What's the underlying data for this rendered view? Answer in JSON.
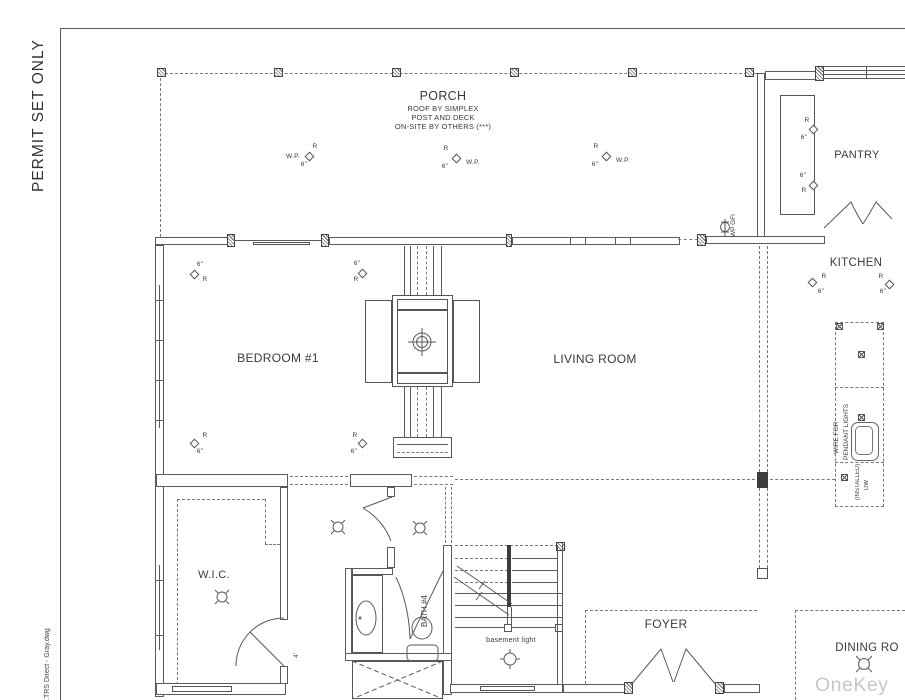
{
  "sheet": {
    "permit_stamp": "PERMIT SET ONLY",
    "file_name": ".TRS Direct - Gray.dwg",
    "watermark": "OneKey MLS"
  },
  "rooms": {
    "porch": {
      "label": "PORCH",
      "notes": [
        "ROOF BY SIMPLEX",
        "POST AND DECK",
        "ON-SITE BY OTHERS (***)"
      ]
    },
    "pantry": {
      "label": "PANTRY"
    },
    "kitchen": {
      "label": "KITCHEN"
    },
    "bedroom1": {
      "label": "BEDROOM #1"
    },
    "living_room": {
      "label": "LIVING ROOM"
    },
    "wic": {
      "label": "W.I.C."
    },
    "bath4": {
      "label": "BATH #4"
    },
    "foyer": {
      "label": "FOYER"
    },
    "dining_room": {
      "label": "DINING RO"
    }
  },
  "symbols": {
    "recessed_label": "R",
    "recessed_size": "6\"",
    "weatherproof": "W.P.",
    "outlet_label": "WP GFI",
    "island_note_1": "WIRE FOR",
    "island_note_2": "PENDANT LIGHTS",
    "dw_note_1": "(INSTALLED)",
    "dw_note_2": "DW",
    "basement_light_label": "basement light",
    "door_width": "4'"
  }
}
